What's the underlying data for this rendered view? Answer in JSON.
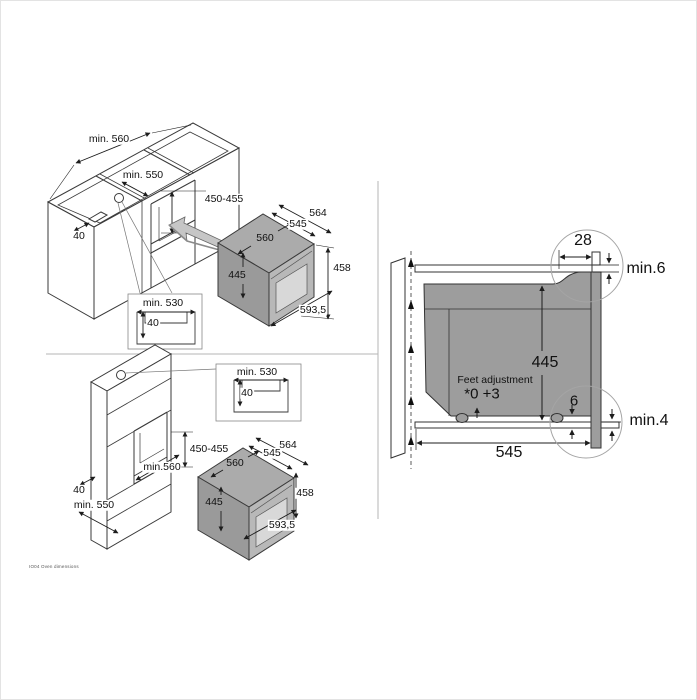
{
  "page": {
    "doc_code": "IO04 Oven dimensions",
    "colors": {
      "line": "#3a3a3a",
      "divider": "#b5b5b5",
      "oven_top": "#ababab",
      "oven_side": "#9a9a9a",
      "oven_front_frame": "#b8b8b8",
      "door_glass": "#d8d8d8",
      "section_body": "#9d9d9d",
      "insert_arrow": "#c6c6c6"
    },
    "icons": {
      "insertion-arrow-icon": "block-arrow-up-left",
      "airflow-arrow-icon": "triangle-up",
      "detail-circle-icon": "callout-circle"
    }
  },
  "views": {
    "base_cabinet": {
      "description": "oven sliding into base cabinet niche (isometric)",
      "labels": [
        {
          "t": "min. 560",
          "x": 108,
          "y": 138,
          "bg": 1
        },
        {
          "t": "min. 550",
          "x": 142,
          "y": 174,
          "bg": 1
        },
        {
          "t": "450-455",
          "x": 223,
          "y": 198,
          "bg": 1
        },
        {
          "t": "40",
          "x": 78,
          "y": 235,
          "bg": 1
        },
        {
          "t": "min. 530",
          "x": 162,
          "y": 302,
          "bg": 1
        },
        {
          "t": "40",
          "x": 152,
          "y": 322,
          "bg": 1
        },
        {
          "t": "564",
          "x": 317,
          "y": 212,
          "bg": 1
        },
        {
          "t": "545",
          "x": 297,
          "y": 223,
          "bg": 1
        },
        {
          "t": "560",
          "x": 264,
          "y": 237,
          "bg": 0
        },
        {
          "t": "445",
          "x": 236,
          "y": 274,
          "bg": 0
        },
        {
          "t": "458",
          "x": 341,
          "y": 267,
          "bg": 1
        },
        {
          "t": "593,5",
          "x": 312,
          "y": 309,
          "bg": 1
        }
      ]
    },
    "tall_cabinet": {
      "description": "oven sliding into tall cabinet niche (isometric)",
      "labels": [
        {
          "t": "min. 530",
          "x": 256,
          "y": 371,
          "bg": 1
        },
        {
          "t": "40",
          "x": 246,
          "y": 392,
          "bg": 1
        },
        {
          "t": "450-455",
          "x": 208,
          "y": 448,
          "bg": 1
        },
        {
          "t": "min.560",
          "x": 161,
          "y": 466,
          "bg": 1
        },
        {
          "t": "40",
          "x": 78,
          "y": 489,
          "bg": 1
        },
        {
          "t": "min. 550",
          "x": 93,
          "y": 504,
          "bg": 1
        },
        {
          "t": "564",
          "x": 287,
          "y": 444,
          "bg": 1
        },
        {
          "t": "545",
          "x": 271,
          "y": 452,
          "bg": 1
        },
        {
          "t": "560",
          "x": 234,
          "y": 462,
          "bg": 0
        },
        {
          "t": "445",
          "x": 213,
          "y": 501,
          "bg": 0
        },
        {
          "t": "458",
          "x": 304,
          "y": 492,
          "bg": 1
        },
        {
          "t": "593,5",
          "x": 281,
          "y": 524,
          "bg": 1
        }
      ]
    },
    "section": {
      "description": "side cross-section with clearances and feet adjustment",
      "labels": [
        {
          "t": "28",
          "x": 582,
          "y": 240,
          "s": 16,
          "bg": 1
        },
        {
          "t": "min.6",
          "x": 645,
          "y": 268,
          "s": 16,
          "bg": 1
        },
        {
          "t": "445",
          "x": 544,
          "y": 362,
          "s": 16,
          "bg": 0
        },
        {
          "t": "Feet adjustment",
          "x": 494,
          "y": 379,
          "s": 10.5,
          "bg": 0
        },
        {
          "t": "*0 +3",
          "x": 481,
          "y": 393,
          "s": 15,
          "bg": 0
        },
        {
          "t": "6",
          "x": 573,
          "y": 400,
          "s": 15,
          "bg": 0
        },
        {
          "t": "min.4",
          "x": 648,
          "y": 420,
          "s": 16,
          "bg": 1
        },
        {
          "t": "545",
          "x": 508,
          "y": 452,
          "s": 16,
          "bg": 1
        }
      ]
    }
  }
}
